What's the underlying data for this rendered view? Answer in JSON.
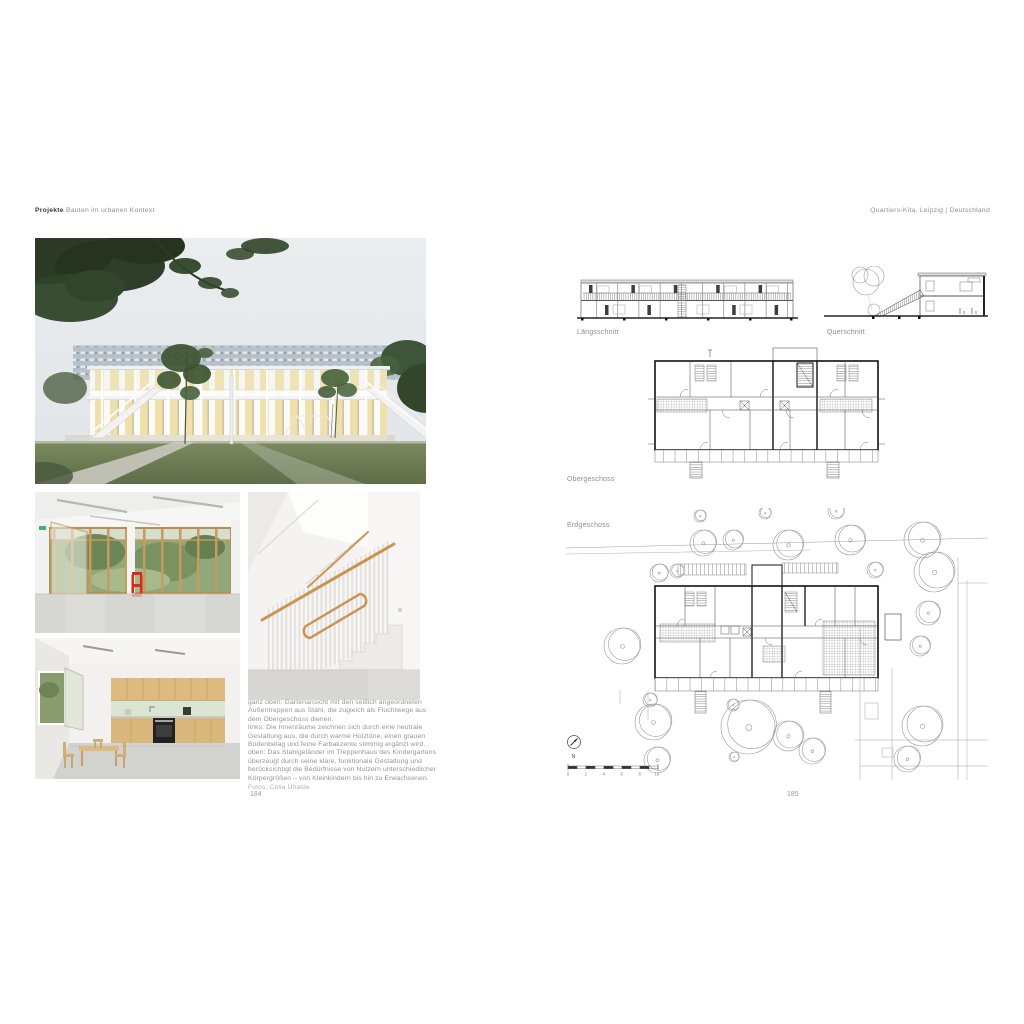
{
  "book": {
    "left_page": {
      "running_head_bold": "Projekte",
      "running_head_rest": " Bauten im urbanen Kontext",
      "page_number": "184",
      "caption_lines": [
        "ganz oben: Gartenansicht mit den seitlich angeordneten",
        "Außentreppen aus Stahl, die zugleich als Fluchtwege aus",
        "dem Obergeschoss dienen.",
        "links: Die Innenräume zeichnen sich durch eine neutrale",
        "Gestaltung aus, die durch warme Holztöne, einen grauen",
        "Bodenbelag und feine Farbakzente stimmig ergänzt wird.",
        "oben: Das Stahlgeländer im Treppenhaus des Kindergartens",
        "überzeugt durch seine klare, funktionale Gestaltung und",
        "berücksichtigt die Bedürfnisse von Nutzern unterschiedlicher",
        "Körpergrößen – von Kleinkindern bis hin zu Erwachsenen."
      ],
      "photo_credit": "Fotos: Célia Uhalde"
    },
    "right_page": {
      "running_head": "Quartiers-Kita, Leipzig | Deutschland",
      "page_number": "185",
      "labels": {
        "laengsschnitt": "Längsschnitt",
        "querschnitt": "Querschnitt",
        "obergeschoss": "Obergeschoss",
        "erdgeschoss": "Erdgeschoss"
      },
      "north_label": "N",
      "scale_ticks": [
        "0",
        "2",
        "4",
        "6",
        "8",
        "10"
      ]
    },
    "colors": {
      "paper": "#ffffff",
      "text_grey": "#8e8e8e",
      "heading_dark": "#3a3a3a",
      "drawing_line": "#666666",
      "wood_handrail": "#cc9350",
      "lawn_green": "#6d7d52",
      "accent_red": "#d42d1f",
      "mint_backsplash": "#dbe5d4"
    }
  }
}
